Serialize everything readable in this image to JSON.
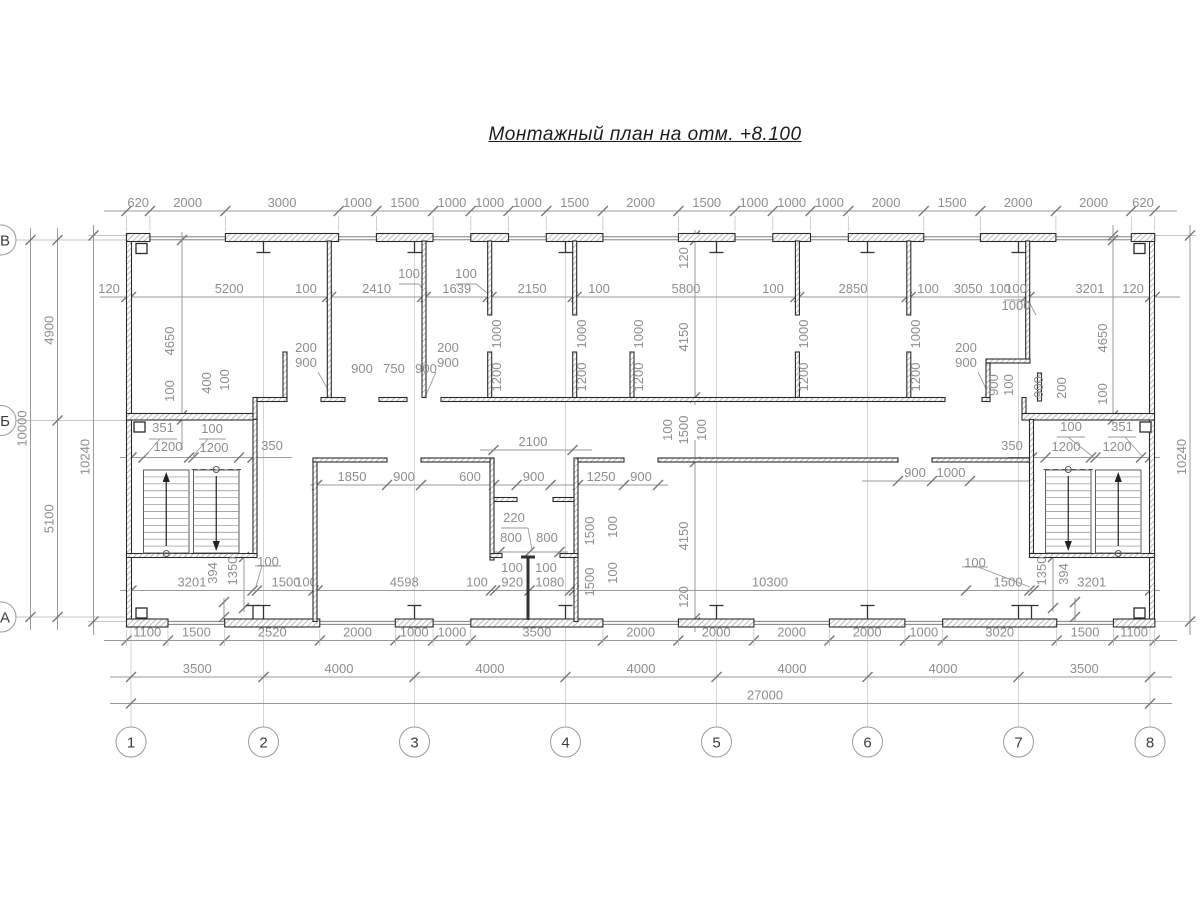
{
  "title": "Монтажный план на отм. +8.100",
  "colors": {
    "wall_line": "#2b2b2b",
    "dim": "#9a9a9a",
    "dim_text": "#8e8e8e",
    "axis_text": "#3c3c3c",
    "hatch": "#9a9a9a"
  },
  "axes": {
    "columns": [
      {
        "label": "1",
        "x": 131
      },
      {
        "label": "2",
        "x": 263.5
      },
      {
        "label": "3",
        "x": 414.5
      },
      {
        "label": "4",
        "x": 565.5
      },
      {
        "label": "5",
        "x": 716.5
      },
      {
        "label": "6",
        "x": 867.5
      },
      {
        "label": "7",
        "x": 1018.5
      },
      {
        "label": "8",
        "x": 1150
      }
    ],
    "rows": [
      {
        "label": "В",
        "y": 240
      },
      {
        "label": "Б",
        "y": 420.5
      },
      {
        "label": "А",
        "y": 617
      }
    ]
  },
  "chains": [
    {
      "name": "dim-top",
      "d": "h",
      "p": 211,
      "line": [
        104,
        1177
      ],
      "ext": [
        216,
        231
      ],
      "ticks": [
        126.5,
        149.9,
        225.4,
        338.7,
        376.4,
        433.1,
        470.8,
        508.5,
        546.3,
        602.9,
        678.4,
        735,
        772.8,
        810.5,
        848.3,
        923.8,
        980.4,
        1055.9,
        1131.3,
        1154.7
      ],
      "labels": [
        "620",
        "2000",
        "3000",
        "1000",
        "1500",
        "1000",
        "1000",
        "1000",
        "1500",
        "2000",
        "1500",
        "1000",
        "1000",
        "1000",
        "2000",
        "1500",
        "2000",
        "2000",
        "620"
      ]
    },
    {
      "name": "dim-inner-top",
      "d": "h",
      "p": 297,
      "line": [
        100,
        1180
      ],
      "ticks": [
        126.5,
        131,
        327.3,
        331.1,
        422.1,
        425.8,
        487.7,
        491.5,
        572.7,
        576.5,
        795.4,
        799.2,
        906.8,
        910.6,
        1025.7,
        1029.5,
        1150.2,
        1154.7
      ],
      "labels": [
        "120",
        "5200",
        "100",
        "2410",
        "",
        "1639",
        "",
        "2150",
        "100",
        "5800",
        "100",
        "2850",
        "100",
        "3050",
        "100",
        "3201",
        "120"
      ],
      "at": {
        "0": 109,
        "2": 306,
        "8": 599,
        "10": 773,
        "12": 928,
        "14": 1000,
        "16": 1133
      }
    },
    {
      "name": "dim-bottom-openings",
      "d": "h",
      "p": 640.5,
      "line": [
        104,
        1177
      ],
      "ext": [
        629,
        646
      ],
      "ticks": [
        126.5,
        168,
        224.7,
        319.8,
        395.3,
        433.1,
        470.8,
        602.9,
        678.4,
        753.9,
        829.4,
        904.9,
        942.7,
        1056.7,
        1113.4,
        1154.7
      ],
      "labels": [
        "1100",
        "1500",
        "2520",
        "2000",
        "1000",
        "1000",
        "3500",
        "2000",
        "2000",
        "2000",
        "2000",
        "1000",
        "3020",
        "1500",
        "1100"
      ]
    },
    {
      "name": "dim-axis-spans",
      "d": "h",
      "p": 677,
      "line": [
        110,
        1172
      ],
      "ticks": [
        131,
        263.5,
        414.5,
        565.5,
        716.5,
        867.5,
        1018.5,
        1150
      ],
      "labels": [
        "3500",
        "4000",
        "4000",
        "4000",
        "4000",
        "4000",
        "3500"
      ]
    },
    {
      "name": "dim-total",
      "d": "h",
      "p": 703.5,
      "line": [
        110,
        1172
      ],
      "ticks": [
        131,
        1150
      ],
      "labels": [
        "27000"
      ],
      "at": {
        "0": 765
      }
    },
    {
      "name": "dim-left-10000",
      "d": "v",
      "p": 30.5,
      "line": [
        228,
        630
      ],
      "ticks": [
        240,
        617
      ],
      "labels": [
        "10000"
      ]
    },
    {
      "name": "dim-left-rows",
      "d": "v",
      "p": 57.5,
      "line": [
        228,
        630
      ],
      "ticks": [
        240,
        420.5,
        617
      ],
      "labels": [
        "4900",
        "5100"
      ]
    },
    {
      "name": "dim-left-10240",
      "d": "v",
      "p": 93.5,
      "line": [
        225,
        635
      ],
      "ticks": [
        235.5,
        621.5
      ],
      "labels": [
        "10240"
      ],
      "at": {
        "0": 457
      }
    },
    {
      "name": "dim-right-10240",
      "d": "v",
      "p": 1190,
      "line": [
        225,
        635
      ],
      "ticks": [
        235.5,
        621.5
      ],
      "labels": [
        "10240"
      ],
      "at": {
        "0": 457
      }
    },
    {
      "name": "dim-right-room",
      "d": "v",
      "p": 1113,
      "line": [
        225,
        425
      ],
      "ticks": [
        235.5,
        240,
        415.5,
        419.5
      ],
      "labels": [
        "",
        "",
        ""
      ]
    },
    {
      "name": "dim-left-room",
      "d": "v",
      "p": 182,
      "line": [
        232,
        450
      ],
      "ticks": [
        240,
        415.5,
        419.5
      ],
      "labels": [
        "",
        ""
      ]
    },
    {
      "name": "dim-mid-top",
      "d": "v",
      "p": 695,
      "line": [
        230,
        405
      ],
      "ticks": [
        235.5,
        240,
        397.5
      ],
      "labels": [
        "",
        ""
      ]
    },
    {
      "name": "dim-mid-bottom",
      "d": "v",
      "p": 695,
      "line": [
        440,
        632
      ],
      "ticks": [
        462,
        618.5,
        622.5
      ],
      "labels": [
        "",
        ""
      ]
    },
    {
      "name": "dim-stair-left",
      "d": "h",
      "p": 457.5,
      "line": [
        120,
        292
      ],
      "ticks": [
        131.5,
        143.5,
        189,
        193.5,
        239,
        252.5
      ],
      "labels": [
        "",
        "",
        "",
        "",
        ""
      ]
    },
    {
      "name": "dim-stair-right",
      "d": "h",
      "p": 457.5,
      "line": [
        1008,
        1160
      ],
      "ticks": [
        1032,
        1045.5,
        1091,
        1095.5,
        1141,
        1150
      ],
      "labels": [
        "",
        "",
        "",
        "",
        ""
      ]
    },
    {
      "name": "dim-lobby-2100",
      "d": "h",
      "p": 450,
      "line": [
        480,
        592
      ],
      "ticks": [
        493.5,
        572.5
      ],
      "labels": [
        "2100"
      ],
      "at": {
        "0": 533
      }
    },
    {
      "name": "dim-lower-rooms",
      "d": "h",
      "p": 485,
      "line": [
        310,
        668
      ],
      "ticks": [
        317,
        387,
        421,
        494,
        516.6,
        550.6,
        578,
        624,
        658
      ],
      "labels": [
        "1850",
        "900",
        "",
        "600",
        "900",
        "",
        "1250",
        "900"
      ],
      "at": {
        "3": 470
      }
    },
    {
      "name": "dim-right-doors",
      "d": "h",
      "p": 481,
      "line": [
        862,
        1035
      ],
      "ticks": [
        898,
        932,
        970
      ],
      "labels": [
        "900",
        "1000"
      ]
    },
    {
      "name": "dim-lower-inner",
      "d": "h",
      "p": 590.5,
      "line": [
        120,
        1160
      ],
      "ticks": [
        131.5,
        252.5,
        257,
        313.5,
        317.5,
        491,
        495,
        529.5,
        570,
        574,
        966,
        1029.5,
        1033.5,
        1150
      ],
      "labels": [
        "3201",
        "",
        "1500",
        "100",
        "4598",
        "100",
        "920",
        "1080",
        "",
        "10300",
        "1500",
        "",
        "3201"
      ],
      "at": {
        "2": 286,
        "3": 306,
        "5": 477,
        "9": 770,
        "10": 1008
      }
    },
    {
      "name": "dim-wc-800",
      "d": "h",
      "p": 552,
      "line": [
        492,
        568
      ],
      "ticks": [
        499.5,
        529.5,
        559.5
      ],
      "labels": [
        "",
        ""
      ]
    },
    {
      "name": "dim-l-1350",
      "d": "v",
      "p": 244,
      "line": [
        553,
        612
      ],
      "ticks": [
        557,
        608
      ],
      "labels": [
        ""
      ]
    },
    {
      "name": "dim-l-394",
      "d": "v",
      "p": 224,
      "line": [
        598,
        621
      ],
      "ticks": [
        602,
        617
      ],
      "labels": [
        ""
      ]
    },
    {
      "name": "dim-r-1350",
      "d": "v",
      "p": 1053,
      "line": [
        553,
        612
      ],
      "ticks": [
        557,
        608
      ],
      "labels": [
        ""
      ]
    },
    {
      "name": "dim-r-394",
      "d": "v",
      "p": 1075,
      "line": [
        598,
        621
      ],
      "ticks": [
        602,
        617
      ],
      "labels": [
        ""
      ]
    }
  ],
  "free_labels": [
    {
      "t": "4650",
      "x": 174,
      "y": 341,
      "r": 1
    },
    {
      "t": "100",
      "x": 174,
      "y": 391,
      "r": 1
    },
    {
      "t": "400",
      "x": 211,
      "y": 383,
      "r": 1
    },
    {
      "t": "100",
      "x": 229,
      "y": 380,
      "r": 1
    },
    {
      "t": "200",
      "x": 306,
      "y": 352
    },
    {
      "t": "900",
      "x": 306,
      "y": 367
    },
    {
      "t": "200",
      "x": 448,
      "y": 352
    },
    {
      "t": "900",
      "x": 448,
      "y": 367
    },
    {
      "t": "900",
      "x": 362,
      "y": 373
    },
    {
      "t": "750",
      "x": 394,
      "y": 373
    },
    {
      "t": "900",
      "x": 426,
      "y": 373
    },
    {
      "t": "1000",
      "x": 501,
      "y": 334,
      "r": 1
    },
    {
      "t": "1200",
      "x": 501,
      "y": 377,
      "r": 1
    },
    {
      "t": "1000",
      "x": 586,
      "y": 334,
      "r": 1
    },
    {
      "t": "1200",
      "x": 586,
      "y": 377,
      "r": 1
    },
    {
      "t": "1000",
      "x": 643,
      "y": 334,
      "r": 1
    },
    {
      "t": "1200",
      "x": 643,
      "y": 377,
      "r": 1
    },
    {
      "t": "1000",
      "x": 808,
      "y": 334,
      "r": 1
    },
    {
      "t": "1200",
      "x": 808,
      "y": 377,
      "r": 1
    },
    {
      "t": "1000",
      "x": 920,
      "y": 334,
      "r": 1
    },
    {
      "t": "1200",
      "x": 920,
      "y": 377,
      "r": 1
    },
    {
      "t": "120",
      "x": 688,
      "y": 258,
      "r": 1
    },
    {
      "t": "4150",
      "x": 688,
      "y": 337,
      "r": 1
    },
    {
      "t": "100",
      "x": 1016,
      "y": 293
    },
    {
      "t": "1000",
      "x": 1016,
      "y": 310
    },
    {
      "t": "200",
      "x": 966,
      "y": 352
    },
    {
      "t": "900",
      "x": 966,
      "y": 367
    },
    {
      "t": "900",
      "x": 998,
      "y": 385,
      "r": 1
    },
    {
      "t": "100",
      "x": 1013,
      "y": 385,
      "r": 1
    },
    {
      "t": "900",
      "x": 1043,
      "y": 387,
      "r": 1
    },
    {
      "t": "200",
      "x": 1066,
      "y": 388,
      "r": 1
    },
    {
      "t": "4650",
      "x": 1107,
      "y": 338,
      "r": 1
    },
    {
      "t": "100",
      "x": 1107,
      "y": 394,
      "r": 1
    },
    {
      "t": "100",
      "x": 409,
      "y": 278
    },
    {
      "t": "100",
      "x": 466,
      "y": 278
    },
    {
      "t": "351",
      "x": 163,
      "y": 432
    },
    {
      "t": "1200",
      "x": 168,
      "y": 451
    },
    {
      "t": "100",
      "x": 212,
      "y": 433
    },
    {
      "t": "1200",
      "x": 214,
      "y": 452
    },
    {
      "t": "350",
      "x": 272,
      "y": 450
    },
    {
      "t": "350",
      "x": 1012,
      "y": 450
    },
    {
      "t": "1200",
      "x": 1066,
      "y": 451
    },
    {
      "t": "100",
      "x": 1071,
      "y": 431
    },
    {
      "t": "1200",
      "x": 1117,
      "y": 451
    },
    {
      "t": "351",
      "x": 1122,
      "y": 431
    },
    {
      "t": "100",
      "x": 672,
      "y": 430,
      "r": 1
    },
    {
      "t": "1500",
      "x": 688,
      "y": 430,
      "r": 1
    },
    {
      "t": "100",
      "x": 706,
      "y": 430,
      "r": 1
    },
    {
      "t": "220",
      "x": 514,
      "y": 522
    },
    {
      "t": "800",
      "x": 511,
      "y": 542
    },
    {
      "t": "800",
      "x": 547,
      "y": 542
    },
    {
      "t": "100",
      "x": 512,
      "y": 572
    },
    {
      "t": "100",
      "x": 546,
      "y": 572
    },
    {
      "t": "1500",
      "x": 594,
      "y": 531,
      "r": 1
    },
    {
      "t": "100",
      "x": 617,
      "y": 527,
      "r": 1
    },
    {
      "t": "1500",
      "x": 594,
      "y": 582,
      "r": 1
    },
    {
      "t": "100",
      "x": 617,
      "y": 573,
      "r": 1
    },
    {
      "t": "4150",
      "x": 688,
      "y": 536,
      "r": 1
    },
    {
      "t": "120",
      "x": 688,
      "y": 597,
      "r": 1
    },
    {
      "t": "394",
      "x": 217,
      "y": 573,
      "r": 1
    },
    {
      "t": "1350",
      "x": 237,
      "y": 571,
      "r": 1
    },
    {
      "t": "1350",
      "x": 1046,
      "y": 571,
      "r": 1
    },
    {
      "t": "394",
      "x": 1068,
      "y": 574,
      "r": 1
    },
    {
      "t": "100",
      "x": 268,
      "y": 566
    },
    {
      "t": "100",
      "x": 975,
      "y": 567
    }
  ],
  "leaders": [
    [
      399,
      284,
      419,
      284
    ],
    [
      419,
      284,
      427,
      296
    ],
    [
      456,
      284,
      476,
      284
    ],
    [
      476,
      284,
      491,
      296
    ],
    [
      1004,
      300,
      1028,
      300
    ],
    [
      1028,
      300,
      1036,
      315
    ],
    [
      149,
      439,
      177,
      439
    ],
    [
      160,
      439,
      145,
      456
    ],
    [
      199,
      439,
      226,
      439
    ],
    [
      208,
      439,
      193,
      456
    ],
    [
      1108,
      437,
      1136,
      437
    ],
    [
      1125,
      437,
      1142,
      456
    ],
    [
      1057,
      437,
      1085,
      437
    ],
    [
      1068,
      437,
      1092,
      456
    ],
    [
      255,
      566,
      281,
      566
    ],
    [
      262,
      566,
      256,
      586
    ],
    [
      962,
      567,
      988,
      567
    ],
    [
      978,
      567,
      1030,
      587
    ],
    [
      501,
      528,
      528,
      528
    ],
    [
      528,
      528,
      532,
      550
    ],
    [
      318,
      372,
      331,
      395
    ],
    [
      436,
      372,
      426,
      395
    ],
    [
      978,
      372,
      989,
      395
    ]
  ]
}
